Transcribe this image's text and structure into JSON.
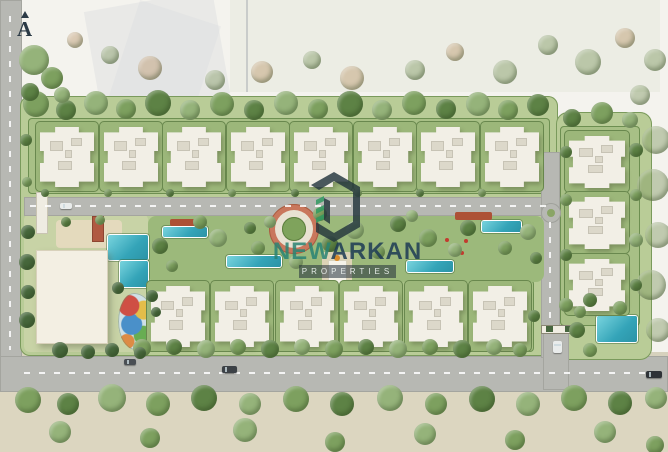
{
  "meta": {
    "description": "Aerial watercolor-style master plan rendering of a gated residential compound",
    "view": "top-down site plan"
  },
  "north_indicator": {
    "label": "A"
  },
  "watermark": {
    "logo": "hexagon-building-monogram",
    "name_primary": "NEW",
    "name_secondary": "ARKAN",
    "tagline": "PROPERTIES",
    "colors": {
      "name_primary_teal": "#2a8474",
      "name_secondary_navy": "#1d3b55",
      "logo_dark": "#22343c",
      "logo_green": "#2f9960",
      "tagline_band_bg": "rgba(33,46,58,0.55)"
    }
  },
  "palette": {
    "paper": "#f4f3ee",
    "compound_green": "#b9cc97",
    "garden_strip": "#a8c086",
    "garden_pad": "#9cb77a",
    "hedge": "#69884e",
    "park_green": "#9cb97b",
    "road_gray": "#b7b8b3",
    "sand": "#dcd6c0",
    "building_white": "#f2efe6",
    "roof_unit": "#dcd8ca",
    "pool_teal": "#34a4b8",
    "plaza_terracotta": "#c9775c",
    "pergola_red": "#ad5136",
    "tree": {
      "t1": "#7da05f",
      "t2": "#5d8245",
      "t3": "#95b37a",
      "tf": "rgba(128,152,98,0.45)",
      "tt": "rgba(188,152,108,0.45)",
      "tp": "#47683c"
    }
  },
  "scene": {
    "summary": {
      "apartment_buildings_north_row": 8,
      "apartment_buildings_south_row": 6,
      "apartment_buildings_east_column": 3,
      "swimming_pools": 7,
      "clubhouse": 1,
      "kids_splash_pad": 1,
      "entrance_gate": 1,
      "central_circular_plaza": 1
    },
    "shapes": [
      {
        "n": "context-wash-left",
        "x": 92,
        "y": 0,
        "w": 130,
        "h": 105,
        "c": "rgba(205,209,214,0.28)",
        "rot": -10
      },
      {
        "n": "context-wash-left-2",
        "x": 118,
        "y": 10,
        "w": 85,
        "h": 130,
        "c": "rgba(214,218,222,0.3)",
        "rot": 18
      },
      {
        "n": "context-wash-top",
        "x": 230,
        "y": 0,
        "w": 430,
        "h": 92,
        "c": "rgba(210,218,200,0.25)"
      },
      {
        "n": "context-pole",
        "x": 246,
        "y": 0,
        "w": 2,
        "h": 92,
        "c": "rgba(150,156,162,0.4)"
      },
      {
        "n": "ground-south",
        "x": 0,
        "y": 390,
        "w": 668,
        "h": 62,
        "c": "#dcd6c0"
      },
      {
        "n": "road-west",
        "x": 0,
        "y": 0,
        "w": 22,
        "h": 392,
        "c": "#b7b8b3",
        "cls": "road"
      },
      {
        "n": "road-main-south",
        "x": 0,
        "y": 356,
        "w": 668,
        "h": 36,
        "c": "#b7b8b3",
        "cls": "road"
      },
      {
        "n": "sidewalk-north-of-road",
        "x": 22,
        "y": 352,
        "w": 646,
        "h": 4,
        "c": "#d6d1bd"
      },
      {
        "n": "compound-base",
        "x": 20,
        "y": 96,
        "w": 538,
        "h": 260,
        "c": "#b9cc97",
        "bc": "#7a9a5c",
        "br": 10
      },
      {
        "n": "compound-east-wing",
        "x": 556,
        "y": 112,
        "w": 96,
        "h": 248,
        "c": "#b9cc97",
        "bc": "#7a9a5c",
        "br": 12
      },
      {
        "n": "garden-strip-north",
        "x": 28,
        "y": 118,
        "w": 522,
        "h": 76,
        "c": "#a8c086",
        "bc": "#6d8f51",
        "br": 4
      },
      {
        "n": "garden-strip-south",
        "x": 146,
        "y": 280,
        "w": 388,
        "h": 72,
        "c": "#a8c086",
        "bc": "#6d8f51",
        "br": 4
      },
      {
        "n": "garden-strip-east",
        "x": 560,
        "y": 126,
        "w": 80,
        "h": 200,
        "c": "#a8c086",
        "bc": "#6d8f51",
        "br": 4
      },
      {
        "n": "amenity-ground-west",
        "x": 24,
        "y": 214,
        "w": 124,
        "h": 138,
        "c": "#c8d3a6",
        "br": 6
      },
      {
        "n": "road-internal-eastwest",
        "x": 24,
        "y": 197,
        "w": 534,
        "h": 19,
        "c": "#b7b8b3",
        "cls": "road"
      },
      {
        "n": "road-internal-vertical",
        "x": 541,
        "y": 152,
        "w": 19,
        "h": 206,
        "c": "#b7b8b3",
        "cls": "road"
      },
      {
        "n": "road-gate-driveway",
        "x": 543,
        "y": 330,
        "w": 26,
        "h": 60,
        "c": "#b7b8b3",
        "cls": "road"
      },
      {
        "n": "roundabout",
        "t": "c",
        "x": 551,
        "y": 213,
        "r": 10,
        "c": "#b7b8b3",
        "bc": "#9fa09a"
      },
      {
        "n": "roundabout-center",
        "t": "c",
        "x": 551,
        "y": 213,
        "r": 4,
        "c": "#8aa566"
      },
      {
        "n": "central-park",
        "x": 148,
        "y": 216,
        "w": 396,
        "h": 66,
        "c": "#9cb97b",
        "br": 8
      },
      {
        "n": "sun-deck",
        "x": 56,
        "y": 220,
        "w": 66,
        "h": 28,
        "c": "#e4dabd",
        "br": 4
      },
      {
        "n": "central-axis-path",
        "x": 322,
        "y": 252,
        "w": 30,
        "h": 60,
        "c": "#ddd3b6",
        "br": 3
      },
      {
        "n": "plaza-outer-ring",
        "t": "c",
        "x": 294,
        "y": 229,
        "r": 25,
        "c": "#c9775c",
        "bc": "#a85d42"
      },
      {
        "n": "plaza-walk-ring",
        "t": "c",
        "x": 294,
        "y": 229,
        "r": 19,
        "c": "#e8e2d2"
      },
      {
        "n": "plaza-garden-center",
        "t": "c",
        "x": 294,
        "y": 229,
        "r": 12,
        "c": "#7fa35c",
        "bc": "#5d7f3f"
      },
      {
        "n": "pool-clubhouse-main",
        "x": 108,
        "y": 235,
        "w": 40,
        "h": 25,
        "cls": "pool"
      },
      {
        "n": "pool-clubhouse-small",
        "x": 120,
        "y": 261,
        "w": 28,
        "h": 26,
        "cls": "pool"
      },
      {
        "n": "lap-pool-1",
        "x": 163,
        "y": 227,
        "w": 44,
        "h": 10,
        "cls": "pool"
      },
      {
        "n": "lap-pool-2",
        "x": 227,
        "y": 256,
        "w": 54,
        "h": 11,
        "cls": "pool"
      },
      {
        "n": "lap-pool-3",
        "x": 407,
        "y": 261,
        "w": 46,
        "h": 11,
        "cls": "pool"
      },
      {
        "n": "lap-pool-4",
        "x": 482,
        "y": 221,
        "w": 39,
        "h": 11,
        "cls": "pool"
      },
      {
        "n": "pool-east",
        "x": 597,
        "y": 316,
        "w": 40,
        "h": 26,
        "cls": "pool"
      },
      {
        "n": "pergola-east",
        "x": 455,
        "y": 212,
        "w": 37,
        "h": 8,
        "c": "#ad5136",
        "br": 2
      },
      {
        "n": "pergola-west",
        "x": 170,
        "y": 219,
        "w": 34,
        "h": 7,
        "c": "#ad5136",
        "br": 2
      },
      {
        "n": "flower-dot",
        "t": "c",
        "x": 447,
        "y": 240,
        "r": 2,
        "c": "#c23b2e"
      },
      {
        "n": "flower-dot",
        "t": "c",
        "x": 456,
        "y": 247,
        "r": 2,
        "c": "#c23b2e"
      },
      {
        "n": "flower-dot",
        "t": "c",
        "x": 466,
        "y": 241,
        "r": 2,
        "c": "#c23b2e"
      },
      {
        "n": "flower-dot",
        "t": "c",
        "x": 452,
        "y": 253,
        "r": 2,
        "c": "#c23b2e"
      },
      {
        "n": "flower-dot",
        "t": "c",
        "x": 462,
        "y": 253,
        "r": 2,
        "c": "#c23b2e"
      },
      {
        "n": "clubhouse",
        "x": 36,
        "y": 250,
        "w": 72,
        "h": 94,
        "c": "#f3efe3",
        "cls": "shadow"
      },
      {
        "n": "kids-splash-pad",
        "x": 118,
        "y": 293,
        "w": 36,
        "h": 57,
        "cls": "kids"
      },
      {
        "n": "entry-trellis",
        "x": 36,
        "y": 192,
        "w": 12,
        "h": 42,
        "c": "#efece2",
        "bc": "#c9c4b2"
      },
      {
        "n": "pool-cabana",
        "x": 92,
        "y": 216,
        "w": 12,
        "h": 26,
        "c": "#b05a42",
        "bc": "#8e4531"
      },
      {
        "n": "axis-pavilion",
        "x": 328,
        "y": 260,
        "w": 19,
        "h": 26,
        "c": "#f6f3ea",
        "bc": "#d8d2bd"
      },
      {
        "n": "axis-pavilion-accent",
        "t": "c",
        "x": 337,
        "y": 258,
        "r": 3,
        "c": "#d98a2b"
      },
      {
        "n": "gate-bar",
        "x": 541,
        "y": 325,
        "w": 37,
        "h": 9,
        "c": "#f0ede2",
        "bc": "#8a8775"
      },
      {
        "n": "gate-booth-west",
        "x": 546,
        "y": 326,
        "w": 7,
        "h": 6,
        "c": "#47663f"
      },
      {
        "n": "gate-booth-east",
        "x": 565,
        "y": 326,
        "w": 7,
        "h": 6,
        "c": "#47663f"
      }
    ],
    "buildings": {
      "top_row": {
        "y": 127,
        "w": 54,
        "h": 60,
        "centers": [
          67,
          131,
          194,
          258,
          321,
          385,
          448,
          512
        ]
      },
      "bottom_row": {
        "y": 286,
        "w": 54,
        "h": 61,
        "centers": [
          178,
          242,
          307,
          371,
          436,
          500
        ]
      },
      "right_column": {
        "x": 569,
        "w": 56,
        "h": 52,
        "tops": [
          136,
          197,
          259
        ]
      }
    },
    "dashes": [
      [
        24,
        372,
        640,
        0
      ],
      [
        30,
        205,
        516,
        0
      ],
      [
        9,
        16,
        334,
        1
      ],
      [
        549,
        222,
        100,
        1
      ]
    ],
    "trees": [
      [
        36,
        104,
        13,
        "t1"
      ],
      [
        66,
        110,
        10,
        "t2"
      ],
      [
        96,
        103,
        12,
        "t3"
      ],
      [
        126,
        109,
        10,
        "t1"
      ],
      [
        158,
        103,
        13,
        "t2"
      ],
      [
        190,
        110,
        10,
        "t3"
      ],
      [
        222,
        104,
        12,
        "t1"
      ],
      [
        254,
        110,
        10,
        "t2"
      ],
      [
        286,
        103,
        12,
        "t3"
      ],
      [
        318,
        109,
        10,
        "t1"
      ],
      [
        350,
        104,
        13,
        "t2"
      ],
      [
        382,
        110,
        10,
        "t3"
      ],
      [
        414,
        103,
        12,
        "t1"
      ],
      [
        446,
        109,
        10,
        "t2"
      ],
      [
        478,
        104,
        12,
        "t3"
      ],
      [
        508,
        110,
        10,
        "t1"
      ],
      [
        538,
        105,
        11,
        "t2"
      ],
      [
        572,
        118,
        9,
        "t2"
      ],
      [
        602,
        113,
        11,
        "t1"
      ],
      [
        630,
        120,
        8,
        "t3"
      ],
      [
        34,
        60,
        15,
        "t3"
      ],
      [
        52,
        78,
        11,
        "t1"
      ],
      [
        30,
        92,
        9,
        "t2"
      ],
      [
        62,
        95,
        8,
        "t3"
      ],
      [
        26,
        140,
        6,
        "t2"
      ],
      [
        27,
        182,
        5,
        "t1"
      ],
      [
        142,
        348,
        9,
        "t1"
      ],
      [
        174,
        347,
        8,
        "t2"
      ],
      [
        206,
        349,
        9,
        "t3"
      ],
      [
        238,
        347,
        8,
        "t1"
      ],
      [
        270,
        349,
        9,
        "t2"
      ],
      [
        302,
        347,
        8,
        "t3"
      ],
      [
        334,
        349,
        9,
        "t1"
      ],
      [
        366,
        347,
        8,
        "t2"
      ],
      [
        398,
        349,
        9,
        "t3"
      ],
      [
        430,
        347,
        8,
        "t1"
      ],
      [
        462,
        349,
        9,
        "t2"
      ],
      [
        494,
        347,
        8,
        "t3"
      ],
      [
        520,
        350,
        7,
        "t1"
      ],
      [
        28,
        400,
        13,
        "t1"
      ],
      [
        68,
        404,
        11,
        "t2"
      ],
      [
        112,
        398,
        14,
        "t3"
      ],
      [
        158,
        404,
        12,
        "t1"
      ],
      [
        204,
        398,
        13,
        "t2"
      ],
      [
        250,
        404,
        11,
        "t3"
      ],
      [
        296,
        399,
        13,
        "t1"
      ],
      [
        342,
        404,
        12,
        "t2"
      ],
      [
        390,
        398,
        13,
        "t3"
      ],
      [
        436,
        404,
        11,
        "t1"
      ],
      [
        482,
        399,
        13,
        "t2"
      ],
      [
        528,
        404,
        12,
        "t3"
      ],
      [
        574,
        398,
        13,
        "t1"
      ],
      [
        620,
        403,
        12,
        "t2"
      ],
      [
        656,
        398,
        11,
        "t3"
      ],
      [
        60,
        432,
        11,
        "t3"
      ],
      [
        150,
        438,
        10,
        "t1"
      ],
      [
        245,
        430,
        12,
        "t3"
      ],
      [
        335,
        442,
        10,
        "t1"
      ],
      [
        425,
        434,
        11,
        "t3"
      ],
      [
        515,
        440,
        10,
        "t1"
      ],
      [
        605,
        432,
        11,
        "t3"
      ],
      [
        655,
        445,
        9,
        "t1"
      ],
      [
        150,
        68,
        12,
        "tt"
      ],
      [
        215,
        80,
        10,
        "tf"
      ],
      [
        262,
        72,
        11,
        "tt"
      ],
      [
        312,
        60,
        9,
        "tf"
      ],
      [
        352,
        78,
        12,
        "tt"
      ],
      [
        415,
        70,
        10,
        "tf"
      ],
      [
        455,
        52,
        9,
        "tt"
      ],
      [
        505,
        72,
        12,
        "tf"
      ],
      [
        548,
        45,
        10,
        "tf"
      ],
      [
        588,
        62,
        13,
        "tf"
      ],
      [
        625,
        38,
        10,
        "tt"
      ],
      [
        655,
        60,
        11,
        "tf"
      ],
      [
        110,
        55,
        9,
        "tf"
      ],
      [
        75,
        40,
        8,
        "tt"
      ],
      [
        640,
        95,
        10,
        "tf"
      ],
      [
        656,
        140,
        14,
        "tf"
      ],
      [
        653,
        185,
        16,
        "tf"
      ],
      [
        658,
        235,
        13,
        "tf"
      ],
      [
        651,
        285,
        15,
        "tf"
      ],
      [
        658,
        330,
        12,
        "tf"
      ],
      [
        160,
        246,
        8,
        "t2"
      ],
      [
        200,
        222,
        7,
        "t1"
      ],
      [
        218,
        238,
        9,
        "t3"
      ],
      [
        250,
        228,
        6,
        "t2"
      ],
      [
        258,
        248,
        7,
        "t1"
      ],
      [
        270,
        222,
        6,
        "t3"
      ],
      [
        320,
        214,
        7,
        "t1"
      ],
      [
        330,
        244,
        8,
        "t2"
      ],
      [
        355,
        230,
        9,
        "t3"
      ],
      [
        378,
        252,
        7,
        "t1"
      ],
      [
        398,
        224,
        8,
        "t2"
      ],
      [
        428,
        238,
        9,
        "t1"
      ],
      [
        455,
        250,
        7,
        "t3"
      ],
      [
        468,
        228,
        8,
        "t2"
      ],
      [
        505,
        248,
        7,
        "t1"
      ],
      [
        528,
        232,
        8,
        "t3"
      ],
      [
        536,
        258,
        6,
        "t2"
      ],
      [
        172,
        266,
        6,
        "t1"
      ],
      [
        296,
        262,
        7,
        "t3"
      ],
      [
        412,
        216,
        6,
        "t3"
      ],
      [
        566,
        152,
        6,
        "t2"
      ],
      [
        566,
        200,
        6,
        "t1"
      ],
      [
        566,
        255,
        6,
        "t2"
      ],
      [
        566,
        305,
        7,
        "t1"
      ],
      [
        636,
        150,
        7,
        "t2"
      ],
      [
        636,
        195,
        6,
        "t1"
      ],
      [
        636,
        240,
        7,
        "t3"
      ],
      [
        636,
        285,
        6,
        "t2"
      ],
      [
        620,
        308,
        7,
        "t1"
      ],
      [
        577,
        330,
        8,
        "t2"
      ],
      [
        590,
        350,
        7,
        "t1"
      ],
      [
        28,
        232,
        7,
        "tp"
      ],
      [
        27,
        262,
        8,
        "tp"
      ],
      [
        28,
        292,
        7,
        "tp"
      ],
      [
        27,
        320,
        8,
        "tp"
      ],
      [
        60,
        350,
        8,
        "tp"
      ],
      [
        88,
        352,
        7,
        "tp"
      ],
      [
        118,
        288,
        6,
        "tp"
      ],
      [
        152,
        296,
        6,
        "tp"
      ],
      [
        112,
        350,
        7,
        "tp"
      ],
      [
        140,
        353,
        6,
        "tp"
      ],
      [
        156,
        312,
        5,
        "tp"
      ],
      [
        66,
        222,
        5,
        "t2"
      ],
      [
        100,
        220,
        5,
        "t1"
      ],
      [
        45,
        193,
        4,
        "t2"
      ],
      [
        108,
        193,
        4,
        "t1"
      ],
      [
        170,
        193,
        4,
        "t2"
      ],
      [
        232,
        193,
        4,
        "t1"
      ],
      [
        295,
        193,
        4,
        "t2"
      ],
      [
        358,
        193,
        4,
        "t1"
      ],
      [
        420,
        193,
        4,
        "t2"
      ],
      [
        482,
        193,
        4,
        "t1"
      ],
      [
        534,
        316,
        6,
        "t2"
      ],
      [
        580,
        312,
        6,
        "t1"
      ],
      [
        590,
        300,
        7,
        "t2"
      ]
    ],
    "cars": [
      [
        222,
        366,
        15,
        7,
        "#3c4146",
        0
      ],
      [
        646,
        371,
        16,
        7,
        "#2e3237",
        0
      ],
      [
        124,
        359,
        12,
        6,
        "#4a4f54",
        0
      ],
      [
        553,
        341,
        9,
        12,
        "#e9eceb",
        1
      ],
      [
        60,
        203,
        12,
        6,
        "#e9eceb",
        0
      ]
    ]
  }
}
